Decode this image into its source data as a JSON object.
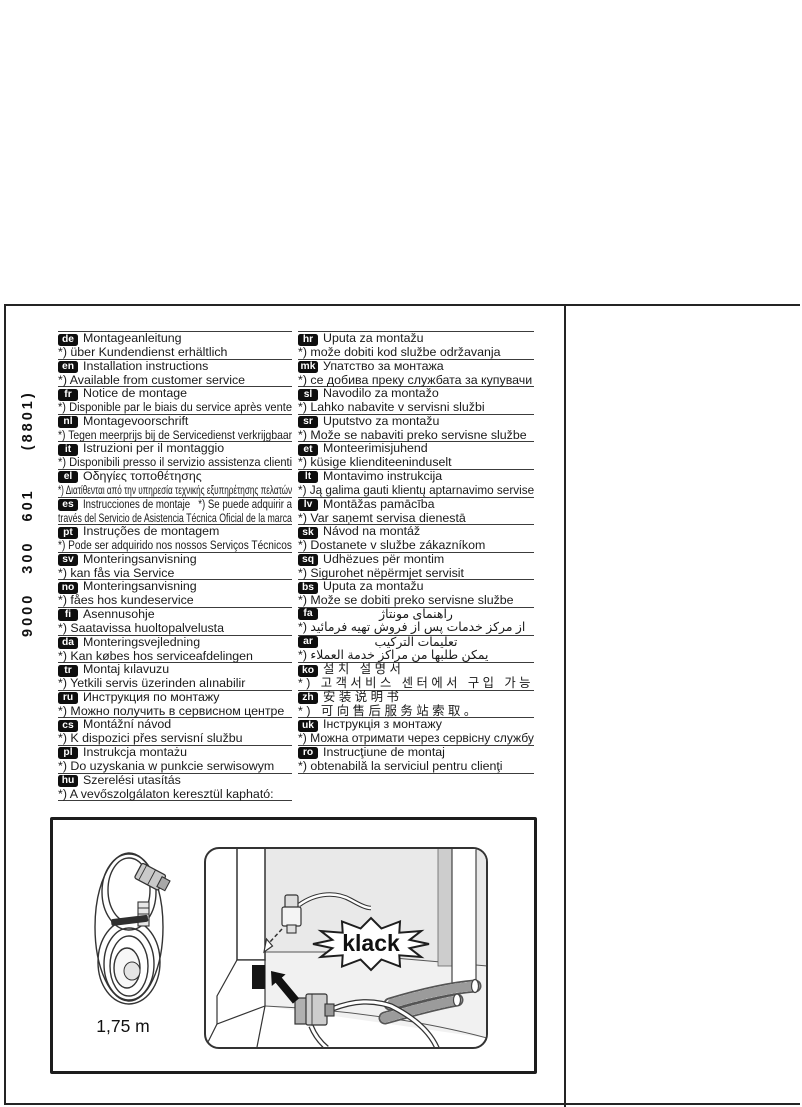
{
  "page": {
    "doc_number_vertical": "9000 300 601  (8801)"
  },
  "illustration": {
    "sound_label": "klack",
    "cable_length_label": "1,75 m"
  },
  "colors": {
    "line": "#242424",
    "rule": "#3c3c3c",
    "badge_bg": "#0e0e0e",
    "text": "#1a1a1a",
    "panel_gray": "#e9e9e9"
  },
  "columns": [
    {
      "side": "left",
      "rows": [
        {
          "code": "de",
          "line1": "Montageanleitung",
          "line2": "*) über Kundendienst erhältlich"
        },
        {
          "code": "en",
          "line1": "Installation instructions",
          "line2": "*) Available from customer service"
        },
        {
          "code": "fr",
          "line1": "Notice de montage",
          "line2": "*) Disponible par le biais du service après vente"
        },
        {
          "code": "nl",
          "line1": "Montagevoorschrift",
          "line2": "*) Tegen meerprijs bij de Servicedienst verkrijgbaar"
        },
        {
          "code": "it",
          "line1": "Istruzioni per il montaggio",
          "line2": "*) Disponibili presso il servizio assistenza clienti"
        },
        {
          "code": "el",
          "line1": "Οδηγίες τοποθέτησης",
          "line2": "*) Διατίθενται από την υπηρεσία τεχνικής εξυπηρέτησης πελατών"
        },
        {
          "code": "es",
          "line1": "Instrucciones de montaje   *) Se puede adquirir a",
          "line2": "través del Servicio de Asistencia Técnica Oficial de la marca"
        },
        {
          "code": "pt",
          "line1": "Instruções de montagem",
          "line2": "*) Pode ser adquirido nos nossos Serviços Técnicos"
        },
        {
          "code": "sv",
          "line1": "Monteringsanvisning",
          "line2": "*) kan fås via Service"
        },
        {
          "code": "no",
          "line1": "Monteringsanvisning",
          "line2": "*) fåes hos kundeservice"
        },
        {
          "code": "fi",
          "line1": "Asennusohje",
          "line2": "*) Saatavissa huoltopalvelusta"
        },
        {
          "code": "da",
          "line1": "Monteringsvejledning",
          "line2": "*) Kan købes hos serviceafdelingen"
        },
        {
          "code": "tr",
          "line1": "Montaj kılavuzu",
          "line2": "*) Yetkili servis üzerinden alınabilir"
        },
        {
          "code": "ru",
          "line1": "Инструкция по монтажу",
          "line2": "*) Можно получить в сервисном центре"
        },
        {
          "code": "cs",
          "line1": "Montážní návod",
          "line2": "*) K dispozici přes servisní službu"
        },
        {
          "code": "pl",
          "line1": "Instrukcja montażu",
          "line2": "*) Do uzyskania w punkcie serwisowym"
        },
        {
          "code": "hu",
          "line1": "Szerelési utasítás",
          "line2": "*) A vevőszolgálaton keresztül kapható:"
        }
      ]
    },
    {
      "side": "right",
      "rows": [
        {
          "code": "hr",
          "line1": "Uputa za montažu",
          "line2": "*) može dobiti kod službe održavanja"
        },
        {
          "code": "mk",
          "line1": "Упатство за монтажа",
          "line2": "*) се добива преку службата за купувачи"
        },
        {
          "code": "sl",
          "line1": "Navodilo za montažo",
          "line2": "*) Lahko nabavite v servisni službi"
        },
        {
          "code": "sr",
          "line1": "Uputstvo za montažu",
          "line2": "*) Može se nabaviti preko servisne službe"
        },
        {
          "code": "et",
          "line1": "Monteerimisjuhend",
          "line2": "*) küsige klienditeeninduselt"
        },
        {
          "code": "lt",
          "line1": "Montavimo instrukcija",
          "line2": "*) Ją galima gauti klientų aptarnavimo servise"
        },
        {
          "code": "lv",
          "line1": "Montāžas pamācība",
          "line2": "*) Var saņemt servisa dienestā"
        },
        {
          "code": "sk",
          "line1": "Návod na montáž",
          "line2": "*) Dostanete v službe zákazníkom"
        },
        {
          "code": "sq",
          "line1": "Udhëzues për montim",
          "line2": "*) Sigurohet nëpërmjet servisit"
        },
        {
          "code": "bs",
          "line1": "Uputa za montažu",
          "line2": "*) Može se dobiti preko servisne službe"
        },
        {
          "code": "fa",
          "cls": "rtl",
          "line1": "راهنمای مونتاژ",
          "line2": "*) از مرکز خدمات پس از فروش تهیه فرمائید"
        },
        {
          "code": "ar",
          "cls": "rtl",
          "line1": "تعليمات التركيب",
          "line2": "*) يمكن طلبها من مراكز خدمة العملاء"
        },
        {
          "code": "ko",
          "cls": "cjk",
          "line1": "설치 설명서",
          "line2": "*) 고객서비스 센터에서 구입 가능"
        },
        {
          "code": "zh",
          "cls": "cjk",
          "line1": "安装说明书",
          "line2": "*) 可向售后服务站索取。"
        },
        {
          "code": "uk",
          "line1": "Інструкція з монтажу",
          "line2": "*) Можна отримати через сервісну службу"
        },
        {
          "code": "ro",
          "line1": "Instrucţiune de montaj",
          "line2": "*) obtenabilă la serviciul pentru clienţi"
        }
      ]
    }
  ]
}
